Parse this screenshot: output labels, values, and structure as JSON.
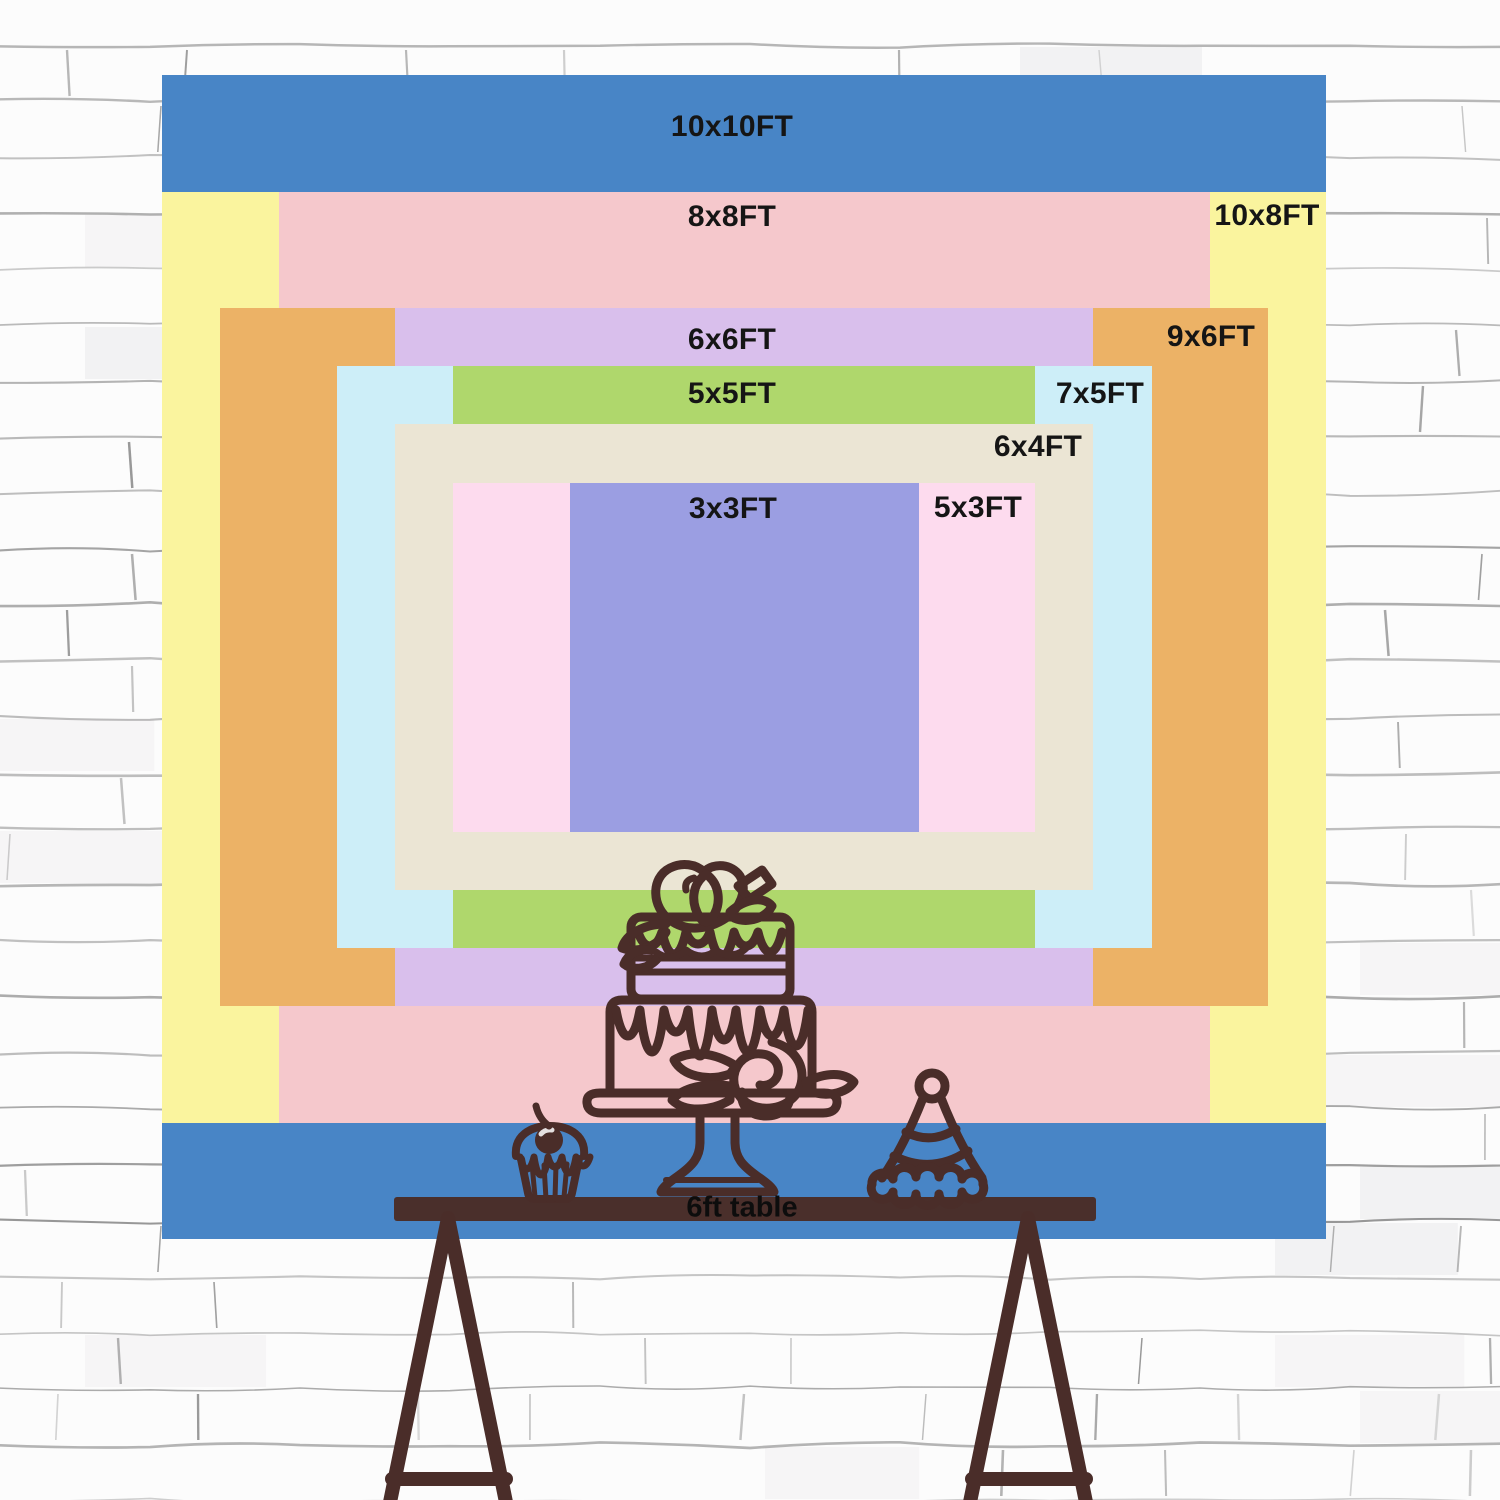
{
  "backdrop": {
    "unit": "FT",
    "px_per_ft": 116.4,
    "center_x": 744,
    "center_y": 657,
    "label_color": "#151515",
    "sizes": [
      {
        "label": "10x10FT",
        "w_ft": 10,
        "h_ft": 10,
        "color": "#4885C6",
        "label_x": 732,
        "label_y": 127
      },
      {
        "label": "10x8FT",
        "w_ft": 10,
        "h_ft": 8,
        "color": "#FAF49E",
        "label_x": 1267,
        "label_y": 216
      },
      {
        "label": "8x8FT",
        "w_ft": 8,
        "h_ft": 8,
        "color": "#F5C8CC",
        "label_x": 732,
        "label_y": 217
      },
      {
        "label": "9x6FT",
        "w_ft": 9,
        "h_ft": 6,
        "color": "#ECB266",
        "label_x": 1211,
        "label_y": 337
      },
      {
        "label": "6x6FT",
        "w_ft": 6,
        "h_ft": 6,
        "color": "#D9BFEC",
        "label_x": 732,
        "label_y": 340
      },
      {
        "label": "7x5FT",
        "w_ft": 7,
        "h_ft": 5,
        "color": "#CDEEF8",
        "label_x": 1100,
        "label_y": 394
      },
      {
        "label": "5x5FT",
        "w_ft": 5,
        "h_ft": 5,
        "color": "#AFD76C",
        "label_x": 732,
        "label_y": 394
      },
      {
        "label": "6x4FT",
        "w_ft": 6,
        "h_ft": 4,
        "color": "#EBE5D4",
        "label_x": 1038,
        "label_y": 447
      },
      {
        "label": "5x3FT",
        "w_ft": 5,
        "h_ft": 3,
        "color": "#FDDBEE",
        "label_x": 978,
        "label_y": 508
      },
      {
        "label": "3x3FT",
        "w_ft": 3,
        "h_ft": 3,
        "color": "#9B9EE2",
        "label_x": 733,
        "label_y": 509
      }
    ]
  },
  "table": {
    "label": "6ft table",
    "bar_color": "#4A2F2B",
    "leg_color": "#4A2D29"
  },
  "doodles": {
    "stroke_color": "#4A2D29",
    "items": [
      "two-tier drip cake with roses on a stand",
      "cupcake with cherry",
      "party hat"
    ]
  },
  "wall": {
    "base_color": "#fcfcfc",
    "mortar_color": "#9a9a9a",
    "course_height": 56
  }
}
